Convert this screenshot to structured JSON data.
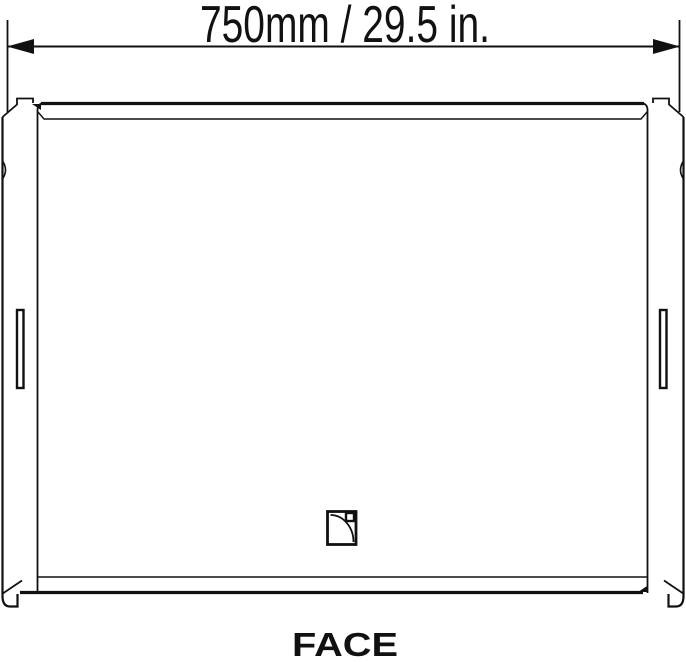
{
  "drawing": {
    "dimension_label": "750mm / 29.5 in.",
    "view_label": "FACE",
    "logo_icon": "l-acoustics-logo",
    "colors": {
      "line": "#111111",
      "background": "#ffffff"
    }
  }
}
